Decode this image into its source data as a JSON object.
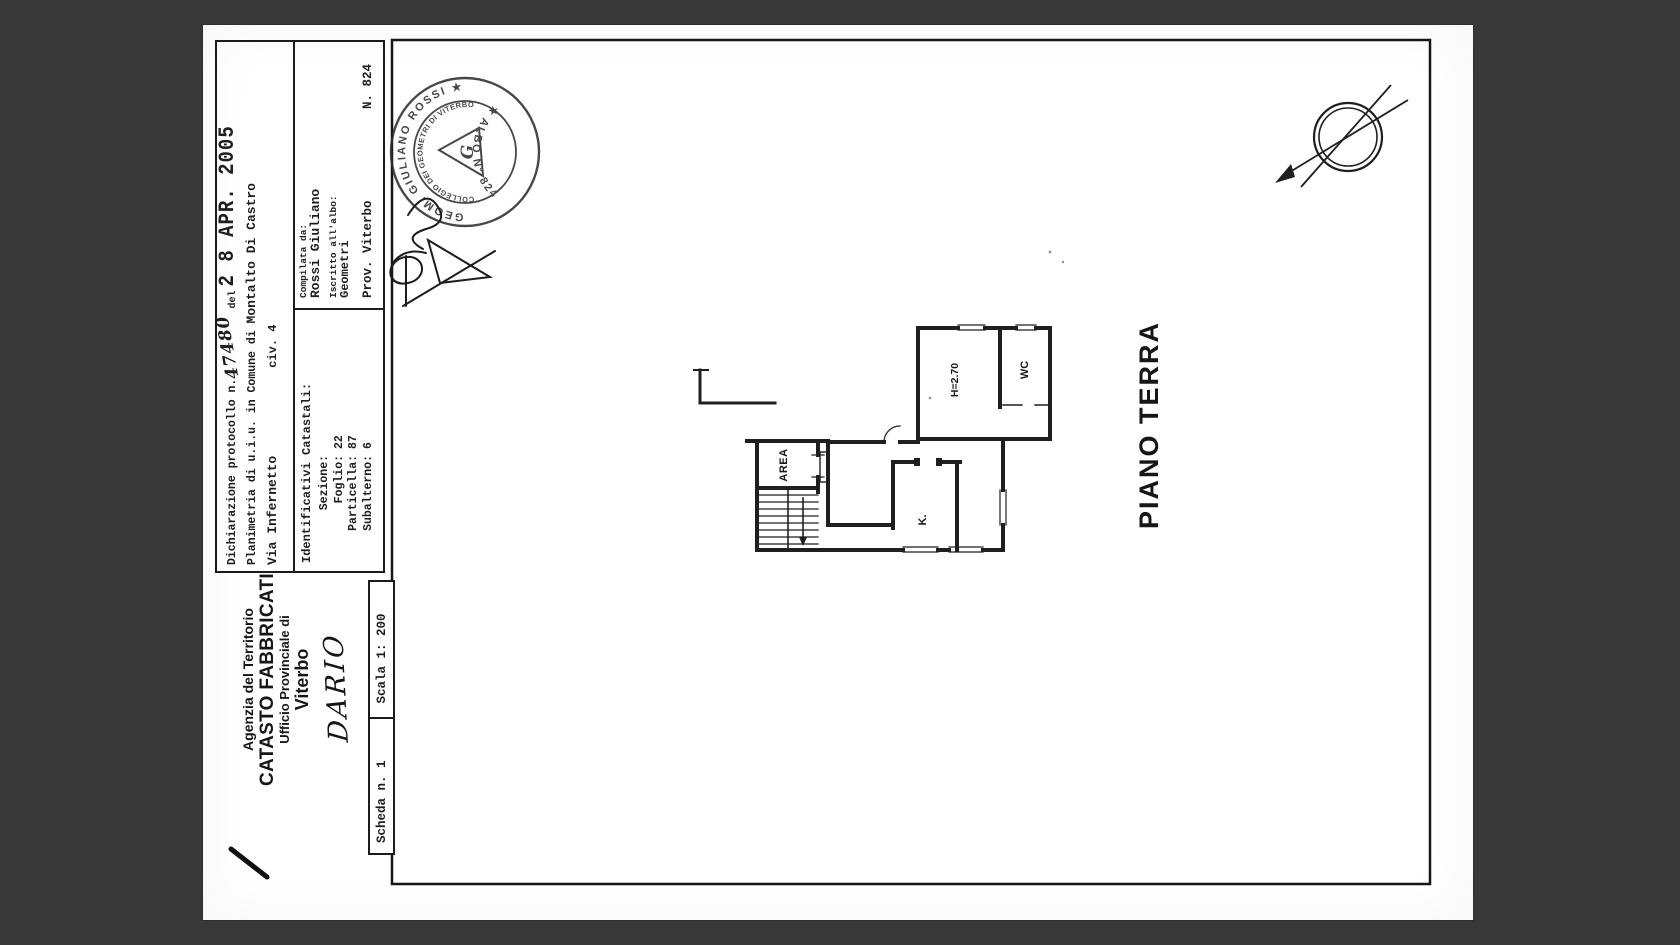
{
  "page": {
    "background": "#383838",
    "paper_color": "#ffffff",
    "ink": "#1e1e1e"
  },
  "header": {
    "declaration": {
      "label_prefix": "Dichiarazione protocollo n.",
      "protocol_number": "47480",
      "del_label": "del",
      "date_stamp": "2 8 APR. 2005"
    },
    "planimetria": {
      "prefix": "Planimetria di u.i.u. in Comune di",
      "comune": "Montalto Di Castro"
    },
    "address": {
      "street": "Via Infernetto",
      "civic": "civ. 4"
    },
    "compiler": {
      "compilata_label": "Compilata da:",
      "name": "Rossi Giuliano",
      "iscritto_label": "Iscritto all'albo:",
      "albo": "Geometri",
      "prov": "Prov. Viterbo",
      "number": "N. 824"
    },
    "identifiers": {
      "title": "Identificativi Catastali:",
      "rows": [
        {
          "label": "Sezione:",
          "value": ""
        },
        {
          "label": "Foglio:",
          "value": "22"
        },
        {
          "label": "Particella:",
          "value": "87"
        },
        {
          "label": "Subalterno:",
          "value": "6"
        }
      ]
    }
  },
  "agency": {
    "line1": "Agenzia del Territorio",
    "line2": "CATASTO FABBRICATI",
    "line3": "Ufficio Provinciale di",
    "line4": "Viterbo",
    "handwritten_name": "DARIO"
  },
  "sheet": {
    "scheda": "Scheda n. 1",
    "scala": "Scala 1: 200"
  },
  "plan": {
    "title": "PIANO TERRA",
    "room_labels": {
      "area": "AREA",
      "kitchen": "K.",
      "wc": "WC",
      "height": "H=2.70"
    }
  },
  "stamp": {
    "outer_top": "GEOM. GIULIANO ROSSI  ★",
    "outer_bottom": "★  ALBO N° 824",
    "inner": "COLLEGIO DEI GEOMETRI DI VITERBO",
    "center_letter": "G"
  }
}
